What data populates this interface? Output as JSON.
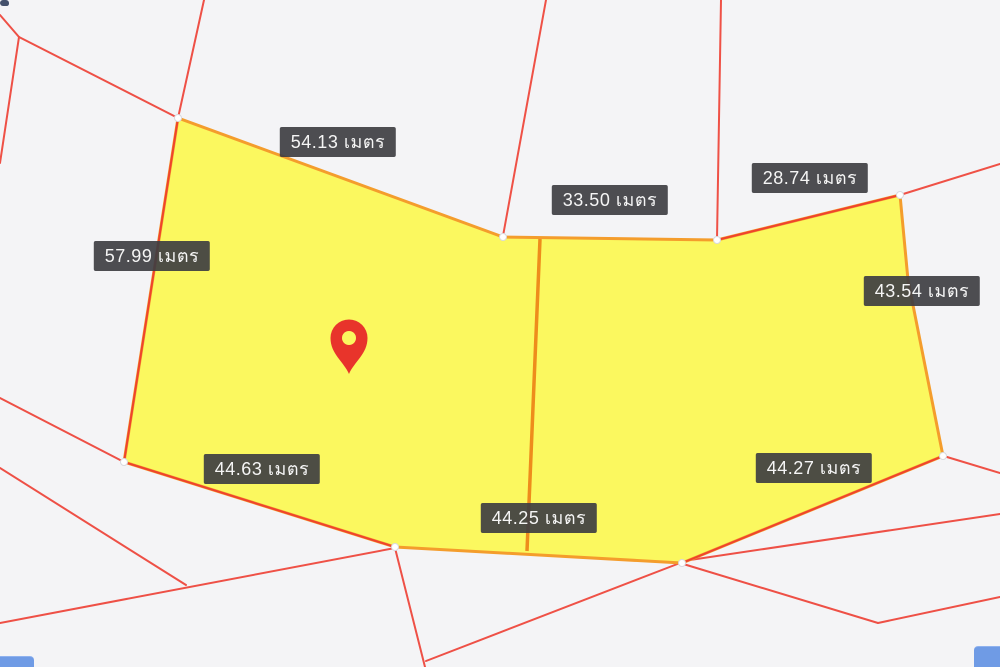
{
  "app": {
    "type": "cadastral-parcel-map-view",
    "unit_word": "เมตร"
  },
  "map": {
    "background_color": "#f4f4f6",
    "boundary_line_color": "#ee3a2e",
    "highlight_parcel": {
      "fill_color": "#fbf85f",
      "border_color": "#f49d2c",
      "divider_color": "#ee8c1c",
      "outer_vertices": [
        [
          178,
          118
        ],
        [
          503,
          237
        ],
        [
          717,
          240
        ],
        [
          900,
          195
        ],
        [
          908,
          280
        ],
        [
          943,
          456
        ],
        [
          682,
          563
        ],
        [
          395,
          547
        ],
        [
          124,
          462
        ]
      ],
      "divider": [
        [
          540,
          239
        ],
        [
          527,
          551
        ]
      ],
      "vertex_dots": [
        [
          178,
          118
        ],
        [
          503,
          237
        ],
        [
          717,
          240
        ],
        [
          900,
          195
        ],
        [
          943,
          456
        ],
        [
          682,
          563
        ],
        [
          395,
          547
        ],
        [
          124,
          462
        ]
      ],
      "red_overlay_edges": [
        [
          [
            178,
            118
          ],
          [
            124,
            462
          ]
        ],
        [
          [
            124,
            462
          ],
          [
            395,
            547
          ]
        ],
        [
          [
            682,
            563
          ],
          [
            943,
            456
          ]
        ],
        [
          [
            717,
            240
          ],
          [
            900,
            195
          ]
        ]
      ]
    },
    "background_lines": [
      [
        [
          0,
          15
        ],
        [
          19,
          37
        ]
      ],
      [
        [
          19,
          37
        ],
        [
          178,
          118
        ]
      ],
      [
        [
          19,
          37
        ],
        [
          0,
          163
        ]
      ],
      [
        [
          204,
          0
        ],
        [
          178,
          118
        ]
      ],
      [
        [
          546,
          0
        ],
        [
          503,
          236
        ]
      ],
      [
        [
          721,
          0
        ],
        [
          717,
          239
        ]
      ],
      [
        [
          900,
          195
        ],
        [
          1000,
          164
        ]
      ],
      [
        [
          0,
          398
        ],
        [
          124,
          462
        ]
      ],
      [
        [
          0,
          468
        ],
        [
          186,
          585
        ]
      ],
      [
        [
          0,
          623
        ],
        [
          395,
          548
        ]
      ],
      [
        [
          395,
          548
        ],
        [
          425,
          667
        ]
      ],
      [
        [
          426,
          661
        ],
        [
          680,
          563
        ]
      ],
      [
        [
          680,
          563
        ],
        [
          878,
          623
        ]
      ],
      [
        [
          878,
          623
        ],
        [
          1000,
          597
        ]
      ],
      [
        [
          947,
          457
        ],
        [
          1000,
          473
        ]
      ],
      [
        [
          1000,
          514
        ],
        [
          690,
          560
        ]
      ]
    ],
    "measurements": [
      {
        "value": "54.13",
        "unit": "เมตร",
        "label": "54.13 เมตร",
        "cx": 338,
        "cy": 142
      },
      {
        "value": "33.50",
        "unit": "เมตร",
        "label": "33.50 เมตร",
        "cx": 610,
        "cy": 200
      },
      {
        "value": "28.74",
        "unit": "เมตร",
        "label": "28.74 เมตร",
        "cx": 810,
        "cy": 178
      },
      {
        "value": "57.99",
        "unit": "เมตร",
        "label": "57.99 เมตร",
        "cx": 152,
        "cy": 256
      },
      {
        "value": "43.54",
        "unit": "เมตร",
        "label": "43.54 เมตร",
        "cx": 922,
        "cy": 291
      },
      {
        "value": "44.63",
        "unit": "เมตร",
        "label": "44.63 เมตร",
        "cx": 262,
        "cy": 469
      },
      {
        "value": "44.25",
        "unit": "เมตร",
        "label": "44.25 เมตร",
        "cx": 539,
        "cy": 518
      },
      {
        "value": "44.27",
        "unit": "เมตร",
        "label": "44.27 เมตร",
        "cx": 814,
        "cy": 468
      }
    ],
    "pin": {
      "x": 349,
      "y": 374,
      "color": "#e8342b",
      "hole_radius": 7,
      "head_radius": 18.5
    }
  }
}
